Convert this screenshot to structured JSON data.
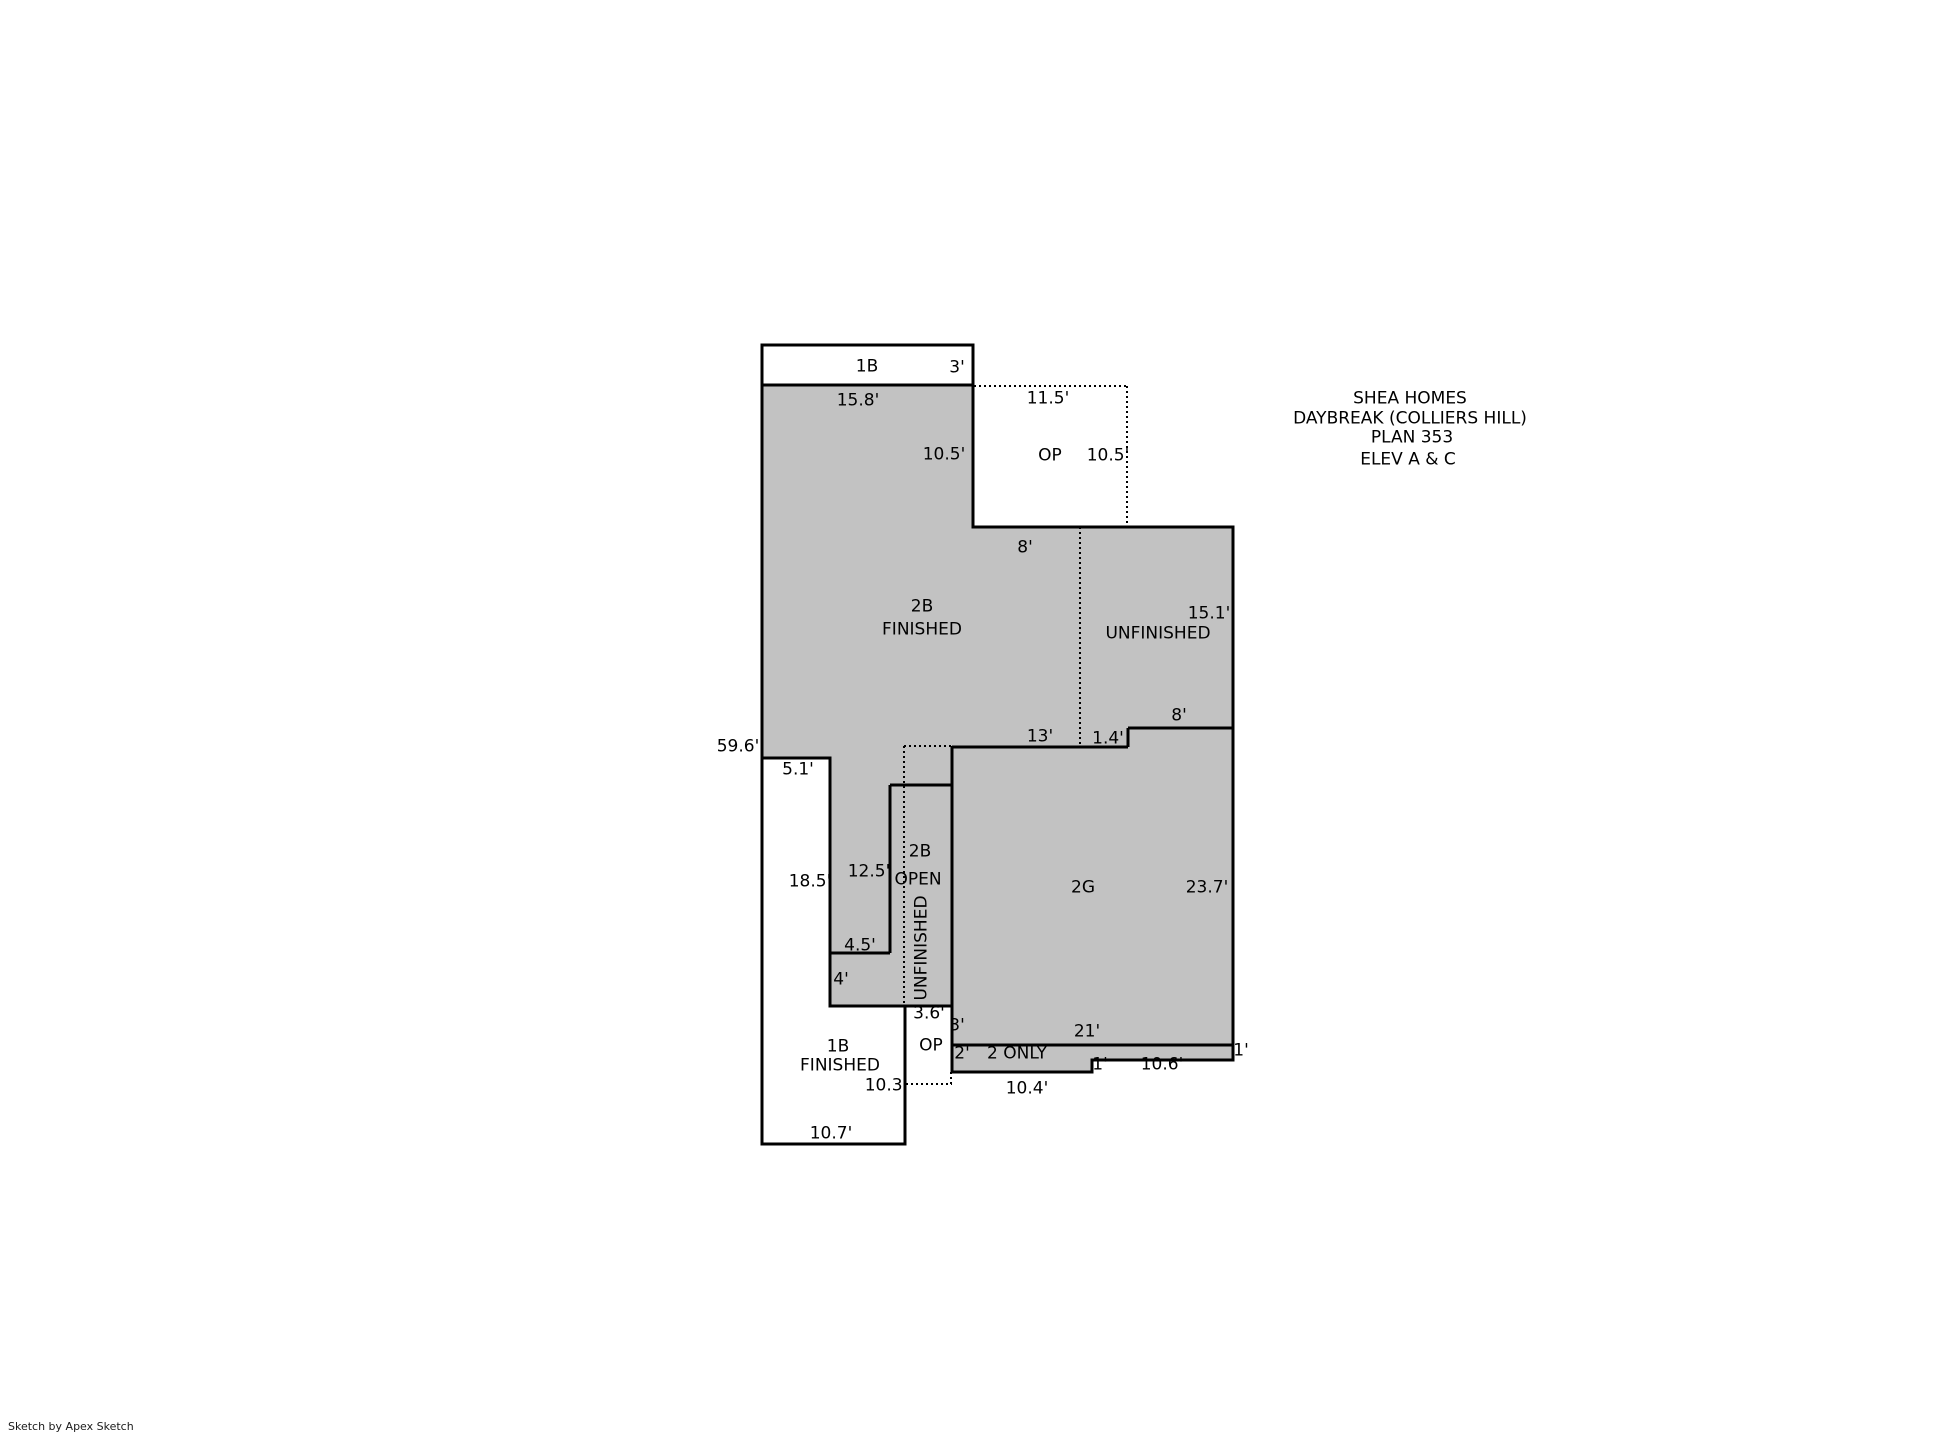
{
  "colors": {
    "area_fill": "#c2c2c2",
    "line": "#000000",
    "background": "#ffffff",
    "text": "#000000"
  },
  "title_block": {
    "lines": [
      "SHEA HOMES",
      "DAYBREAK (COLLIERS HILL)",
      "PLAN 353",
      "ELEV A & C"
    ]
  },
  "footer": {
    "credit": "Sketch by Apex Sketch"
  },
  "floor_plan": {
    "upper_strip": {
      "code": "1B",
      "height": "3'"
    },
    "main": {
      "top_width": "15.8'",
      "left_wall_total": "59.6'"
    },
    "porch_upper": {
      "code": "OP",
      "top_width": "11.5'",
      "left_height": "10.5'",
      "right_height": "10.5'"
    },
    "second_floor": {
      "code": "2B",
      "status": "FINISHED",
      "top_segment": "8'"
    },
    "unfinished_attic": {
      "status": "UNFINISHED",
      "right_height": "15.1'",
      "step_width": "8'",
      "step_drop": "1.4'",
      "top_width": "13'"
    },
    "open_area": {
      "code": "2B",
      "label": "OPEN",
      "status": "UNFINISHED",
      "left_height": "12.5'",
      "step_width": "4.5'",
      "step_height": "4'"
    },
    "garage": {
      "code": "2G",
      "right_height": "23.7'",
      "bottom_width": "21'"
    },
    "first_floor": {
      "code": "1B",
      "status": "FINISHED",
      "top_notch": "5.1'",
      "right_height": "18.5'",
      "lower_right_wall": "10.3'",
      "bottom_width": "10.7'"
    },
    "porch_lower": {
      "code": "OP",
      "top_width": "3.6'",
      "right_height": "3'"
    },
    "second_only_strip": {
      "label": "2 ONLY",
      "left_height": "2'",
      "left_width": "10.4'",
      "step": "1'",
      "right_width": "10.6'",
      "right_height": "1'"
    }
  }
}
